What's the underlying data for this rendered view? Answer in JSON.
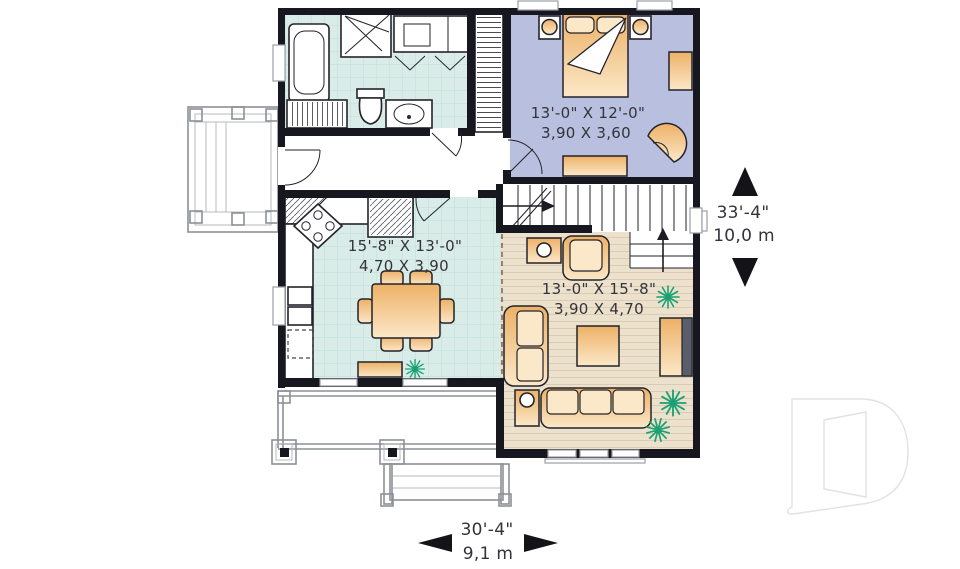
{
  "labels": {
    "bedroom": {
      "imperial": "13'-0\" X 12'-0\"",
      "metric": "3,90 X 3,60"
    },
    "kitchen": {
      "imperial": "15'-8\" X 13'-0\"",
      "metric": "4,70 X 3,90"
    },
    "living": {
      "imperial": "13'-0\" X 15'-8\"",
      "metric": "3,90 X 4,70"
    },
    "depth": {
      "imperial": "33'-4\"",
      "metric": "10,0 m"
    },
    "width": {
      "imperial": "30'-4\"",
      "metric": "9,1 m"
    }
  },
  "brand_logo": "D",
  "icons": {
    "depth_arrows": [
      "triangle-up",
      "triangle-down"
    ],
    "width_arrows": [
      "triangle-left",
      "triangle-right"
    ],
    "stair_arrows": [
      "arrow-right-up-stairs",
      "arrow-up-landing"
    ]
  },
  "rooms": {
    "bathroom_fixtures": [
      "bathtub",
      "corner-shower",
      "vanity-sink",
      "toilet",
      "linen-closet"
    ],
    "bedroom_fixtures": [
      "double-bed",
      "nightstand",
      "nightstand",
      "dresser",
      "corner-chair"
    ],
    "kitchen_fixtures": [
      "corner-stove",
      "counter",
      "double-sink",
      "dishwasher",
      "dining-table",
      "six-chairs",
      "window-bench",
      "plant"
    ],
    "living_fixtures": [
      "sofa",
      "loveseat",
      "armchair",
      "coffee-table",
      "end-table",
      "side-table",
      "tv-unit",
      "plants"
    ],
    "exterior": [
      "side-deck",
      "front-porch",
      "porch-columns",
      "front-steps"
    ]
  },
  "colors": {
    "wall": "#17171f",
    "tile_floor": "#d9ece8",
    "tile_line": "#c0ded7",
    "bedroom_floor": "#b9c0df",
    "wood_floor": "#ece1cc",
    "wood_line": "#dccbb0",
    "furniture_dark": "#edb167",
    "furniture_light": "#fbe8c8",
    "outline": "#23232b",
    "plant": "#1aa173",
    "deck_line": "#8c9196",
    "label_text": "#33333b",
    "logo_line": "#e2e2e2"
  }
}
